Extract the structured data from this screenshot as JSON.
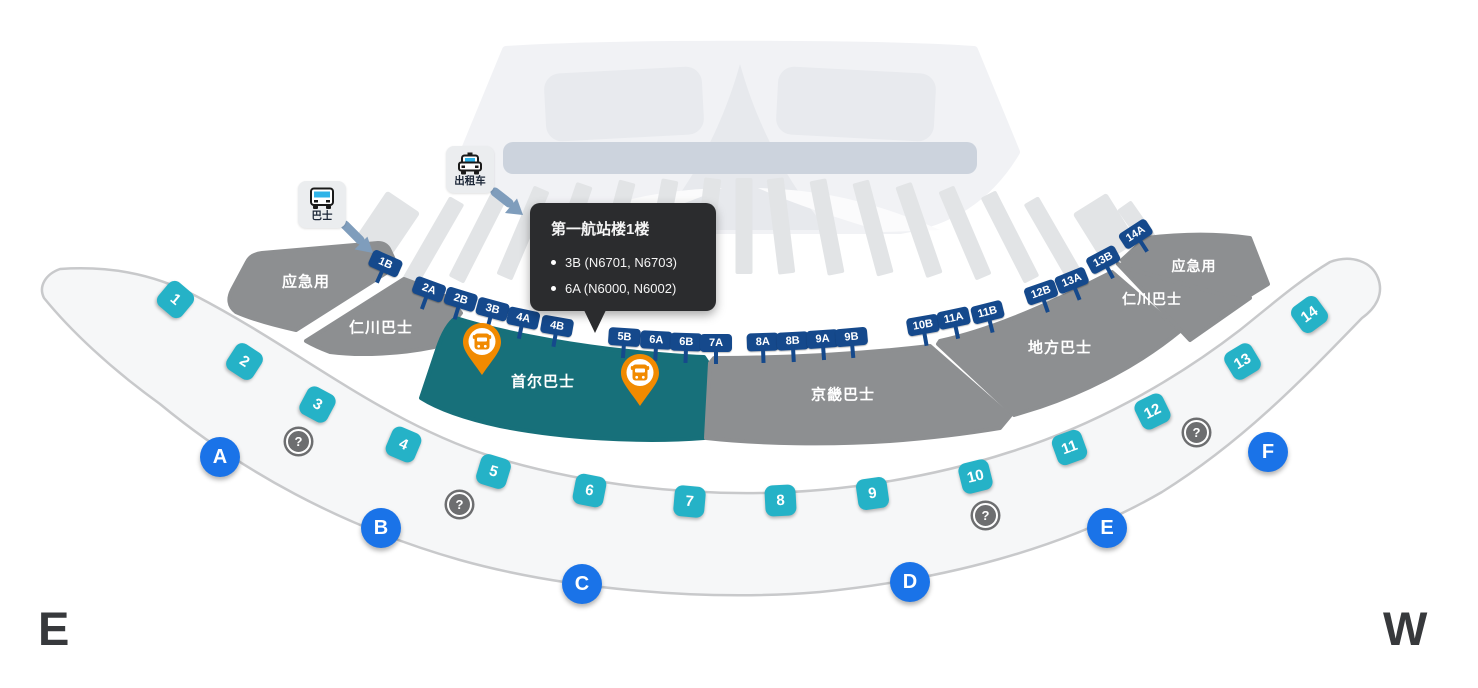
{
  "compass": {
    "east": "E",
    "west": "W"
  },
  "tooltip": {
    "title": "第一航站楼1楼",
    "items": [
      "3B (N6701, N6703)",
      "6A (N6000, N6002)"
    ]
  },
  "transport": [
    {
      "label": "巴士"
    },
    {
      "label": "出租车"
    }
  ],
  "zones": [
    {
      "label": "应急用"
    },
    {
      "label": "仁川巴士"
    },
    {
      "label": "首尔巴士"
    },
    {
      "label": "京畿巴士"
    },
    {
      "label": "地方巴士"
    },
    {
      "label": "仁川巴士"
    },
    {
      "label": "应急用"
    }
  ],
  "stops": [
    "1B",
    "2A",
    "2B",
    "3B",
    "4A",
    "4B",
    "5B",
    "6A",
    "6B",
    "7A",
    "8A",
    "8B",
    "9A",
    "9B",
    "10B",
    "11A",
    "11B",
    "12B",
    "13A",
    "13B",
    "14A"
  ],
  "platforms": [
    "1",
    "2",
    "3",
    "4",
    "5",
    "6",
    "7",
    "8",
    "9",
    "10",
    "11",
    "12",
    "13",
    "14"
  ],
  "gates": [
    "A",
    "B",
    "C",
    "D",
    "E",
    "F"
  ],
  "icons": {
    "help": "?"
  },
  "colors": {
    "stop_flag": "#15498c",
    "platform_square": "#25b2c7",
    "gate_circle": "#1a73e8",
    "zone_gray": "#8d8f91",
    "zone_teal": "#17707a",
    "pin_orange": "#f18a00",
    "arrow_blue": "#7f9dbc",
    "tooltip_bg": "#2b2c2e"
  }
}
